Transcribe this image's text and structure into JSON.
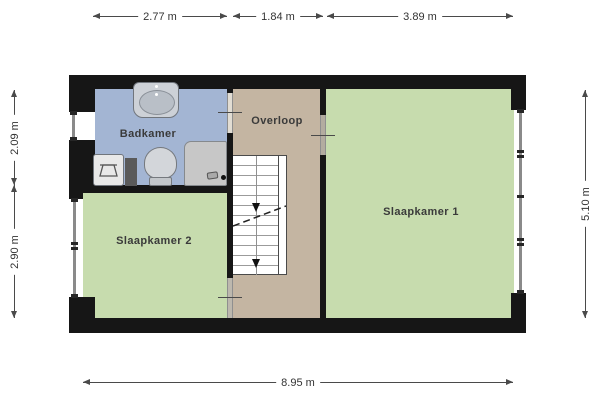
{
  "rooms": [
    {
      "name": "Badkamer",
      "color": "#a3b5d3"
    },
    {
      "name": "Overloop",
      "color": "#c4b5a2"
    },
    {
      "name": "Slaapkamer 1",
      "color": "#c7dcae"
    },
    {
      "name": "Slaapkamer 2",
      "color": "#c7dcae"
    }
  ],
  "dimensions": {
    "top": [
      {
        "label": "2.77 m"
      },
      {
        "label": "1.84 m"
      },
      {
        "label": "3.89 m"
      }
    ],
    "left": [
      {
        "label": "2.09 m"
      },
      {
        "label": "2.90 m"
      }
    ],
    "right": [
      {
        "label": "5.10 m"
      }
    ],
    "bottom": [
      {
        "label": "8.95 m"
      }
    ]
  },
  "fixtures": [
    "sink-icon",
    "toilet-icon",
    "shower-icon",
    "laundry-basket-icon"
  ],
  "stairs": {
    "direction": "down"
  },
  "colors": {
    "wall": "#161616",
    "window_glass": "#8a8a8a",
    "door_gap": "#b3aca0",
    "stair_fill": "#ffffff",
    "background": "#ffffff"
  }
}
